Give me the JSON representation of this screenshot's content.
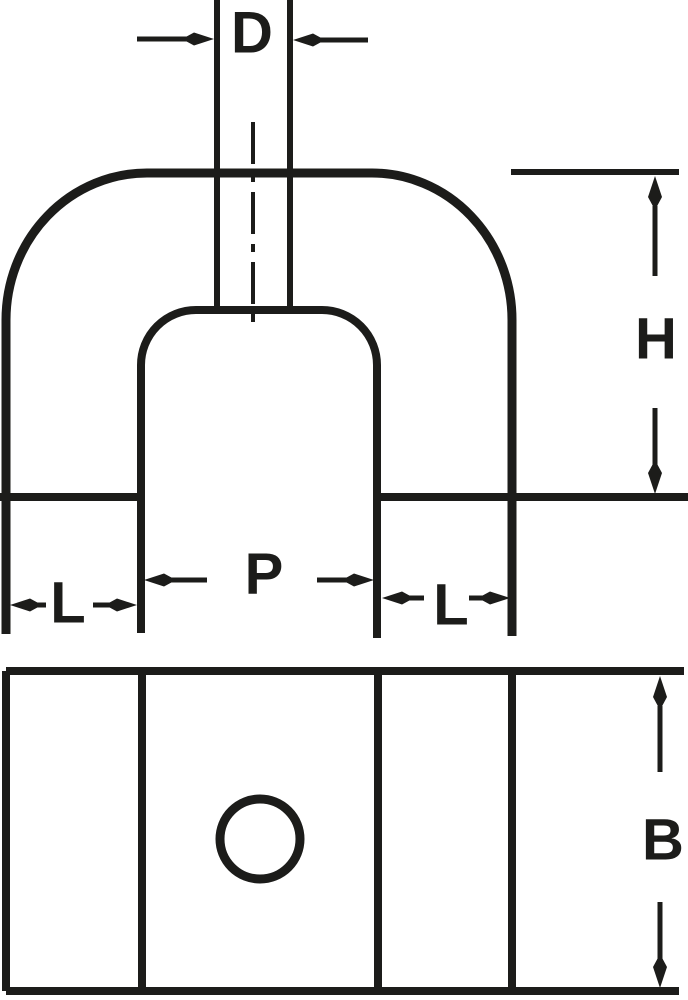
{
  "colors": {
    "ink": "#1c1c1a",
    "paper": "#ffffff"
  },
  "front_view": {
    "stem_diameter_label": "D",
    "body_height_label": "H",
    "pole_gap_label": "P",
    "pole_width_left_label": "L",
    "pole_width_right_label": "L"
  },
  "bottom_view": {
    "depth_label": "B"
  }
}
